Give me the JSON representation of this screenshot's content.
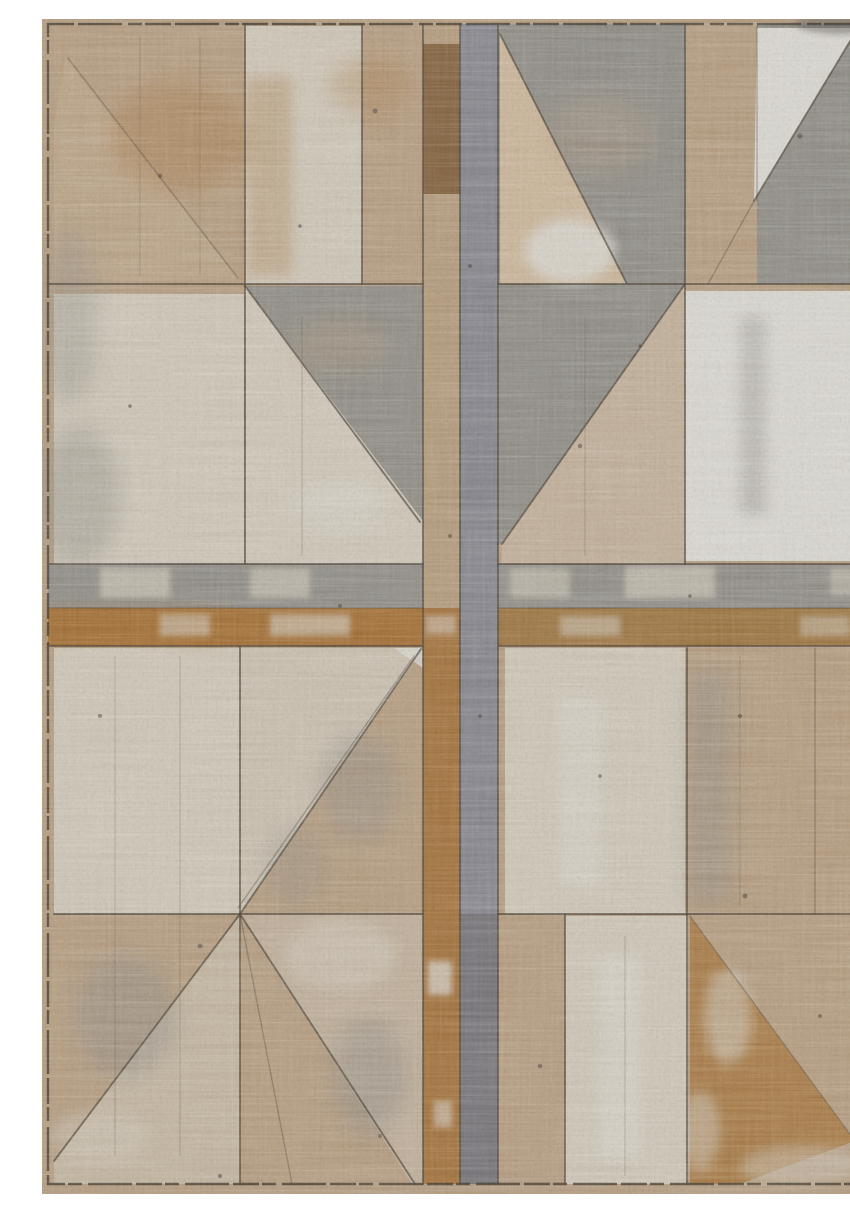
{
  "image": {
    "type": "product-photo",
    "subject": "Distressed geometric patchwork area rug",
    "alt": "Overhead product photo of a rectangular vintage-look area rug. A weathered geometric patchwork of tan, cream, warm gray and rust panels and triangles is divided by dark seam lines; a central cross made of a brown strip and a gray strip splits the rug into four quadrants, each holding cream rectangles and large gray or tan triangles, all over a woven, heavily distressed texture.",
    "orientation": "portrait",
    "style": "distressed geometric patchwork"
  },
  "palette": {
    "photo_white": "#ffffff",
    "base_tan": "#b29a7e",
    "strip_tan": "#b0987a",
    "cream": "#cbc3b4",
    "cream_soft": "#c6bcab",
    "white_panel": "#d7d4cd",
    "beige": "#c7b296",
    "gray": "#8d8a83",
    "gray_band": "#8e8b84",
    "gray_strip": "#84838a",
    "gray_dark": "#5d5a55",
    "rust_band": "#a06d36",
    "brown_band": "#9a7342",
    "brown_top": "#7d5c3a",
    "rust_strip": "#9e6c36",
    "seam_line": "#4a4136",
    "border_line": "#3f382d",
    "speck": "#4e443a"
  }
}
